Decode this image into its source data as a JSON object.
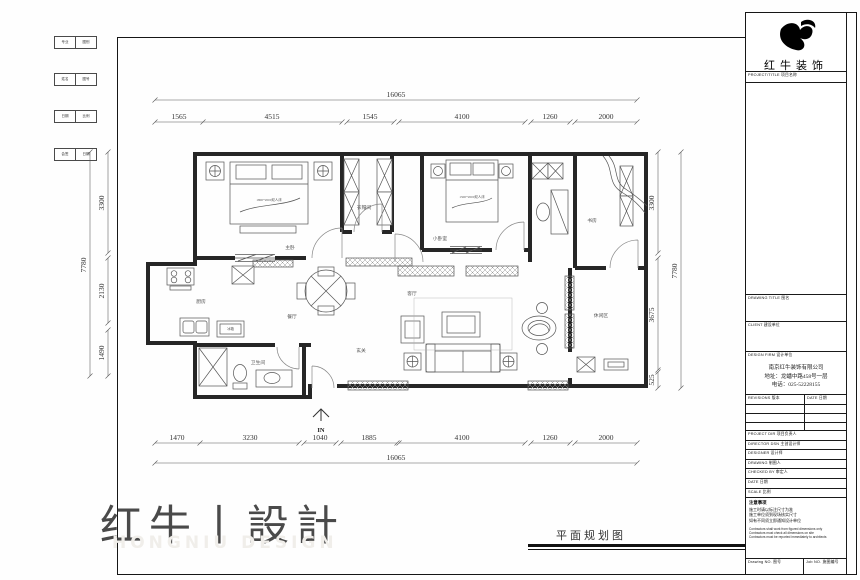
{
  "frame": {
    "strip_rows": [
      {
        "c1": "专业",
        "c2": "图别"
      },
      {
        "c1": "姓名",
        "c2": "图号"
      },
      {
        "c1": "日期",
        "c2": "比例"
      },
      {
        "c1": "会签",
        "c2": "日期"
      }
    ]
  },
  "dims": {
    "top_total": "16065",
    "top": [
      "1565",
      "4515",
      "1545",
      "4100",
      "1260",
      "2000"
    ],
    "bottom": [
      "1470",
      "3230",
      "1040",
      "1885",
      "4100",
      "1260",
      "2000"
    ],
    "bottom_total": "16065",
    "left": [
      "3300",
      "2130",
      "1490"
    ],
    "left_total": "7780",
    "right": [
      "3300",
      "3675",
      "525"
    ],
    "right_total": "7780",
    "entrance": "IN"
  },
  "plan": {
    "rooms": [
      {
        "label": "主卧"
      },
      {
        "label": "衣帽间"
      },
      {
        "label": "小卧室"
      },
      {
        "label": "书房"
      },
      {
        "label": "客厅"
      },
      {
        "label": "餐厅"
      },
      {
        "label": "厨房"
      },
      {
        "label": "卫生间"
      },
      {
        "label": "休闲区"
      },
      {
        "label": "玄关"
      }
    ],
    "furniture": {
      "master_bed": "1800*2000双人床",
      "second_bed": "1500*2000双人床",
      "fridge": "冰箱"
    }
  },
  "titleblock": {
    "brand": "红牛装饰",
    "project_title": "PROJECT/TITLE  项目名称",
    "drawing_title": "DRAWING TITLE  图名",
    "client": "CLIENT  建设单位",
    "design_firm": "DESIGN FIRM  设计单位",
    "company": [
      "南京红牛装饰有限公司",
      "地址：龙蟠中路458号一层",
      "电话：025-52228155"
    ],
    "revisions": "REVISIONS  版本",
    "date_col": "DATE  日期",
    "rows": [
      "PROJECT DIR  项目负责人",
      "DIRECTOR DSN  主创设计师",
      "DESIGNER  设计师",
      "DRAWING  制图人",
      "CHECKED BY  审定人",
      "DATE  日期",
      "SCALE  比例"
    ],
    "notes_title": "注意事项",
    "notes_cn": [
      "施工时请以标注尺寸为准",
      "施工单位须到现场核实尺寸",
      "如有不同须立即通知设计单位"
    ],
    "notes_en": [
      "Contractors shall work from figured dimensions only",
      "Contractors must check all dimensions on site",
      "Contractors must be reported immediately to architects"
    ],
    "drawing_no": "Drawing NO.  图号",
    "job_no": "Job NO.  施图编号"
  },
  "footer": {
    "brand": "红牛丨設計",
    "brand_en": "HONGNIU DESIGN",
    "drawing_name": "平面规划图"
  }
}
